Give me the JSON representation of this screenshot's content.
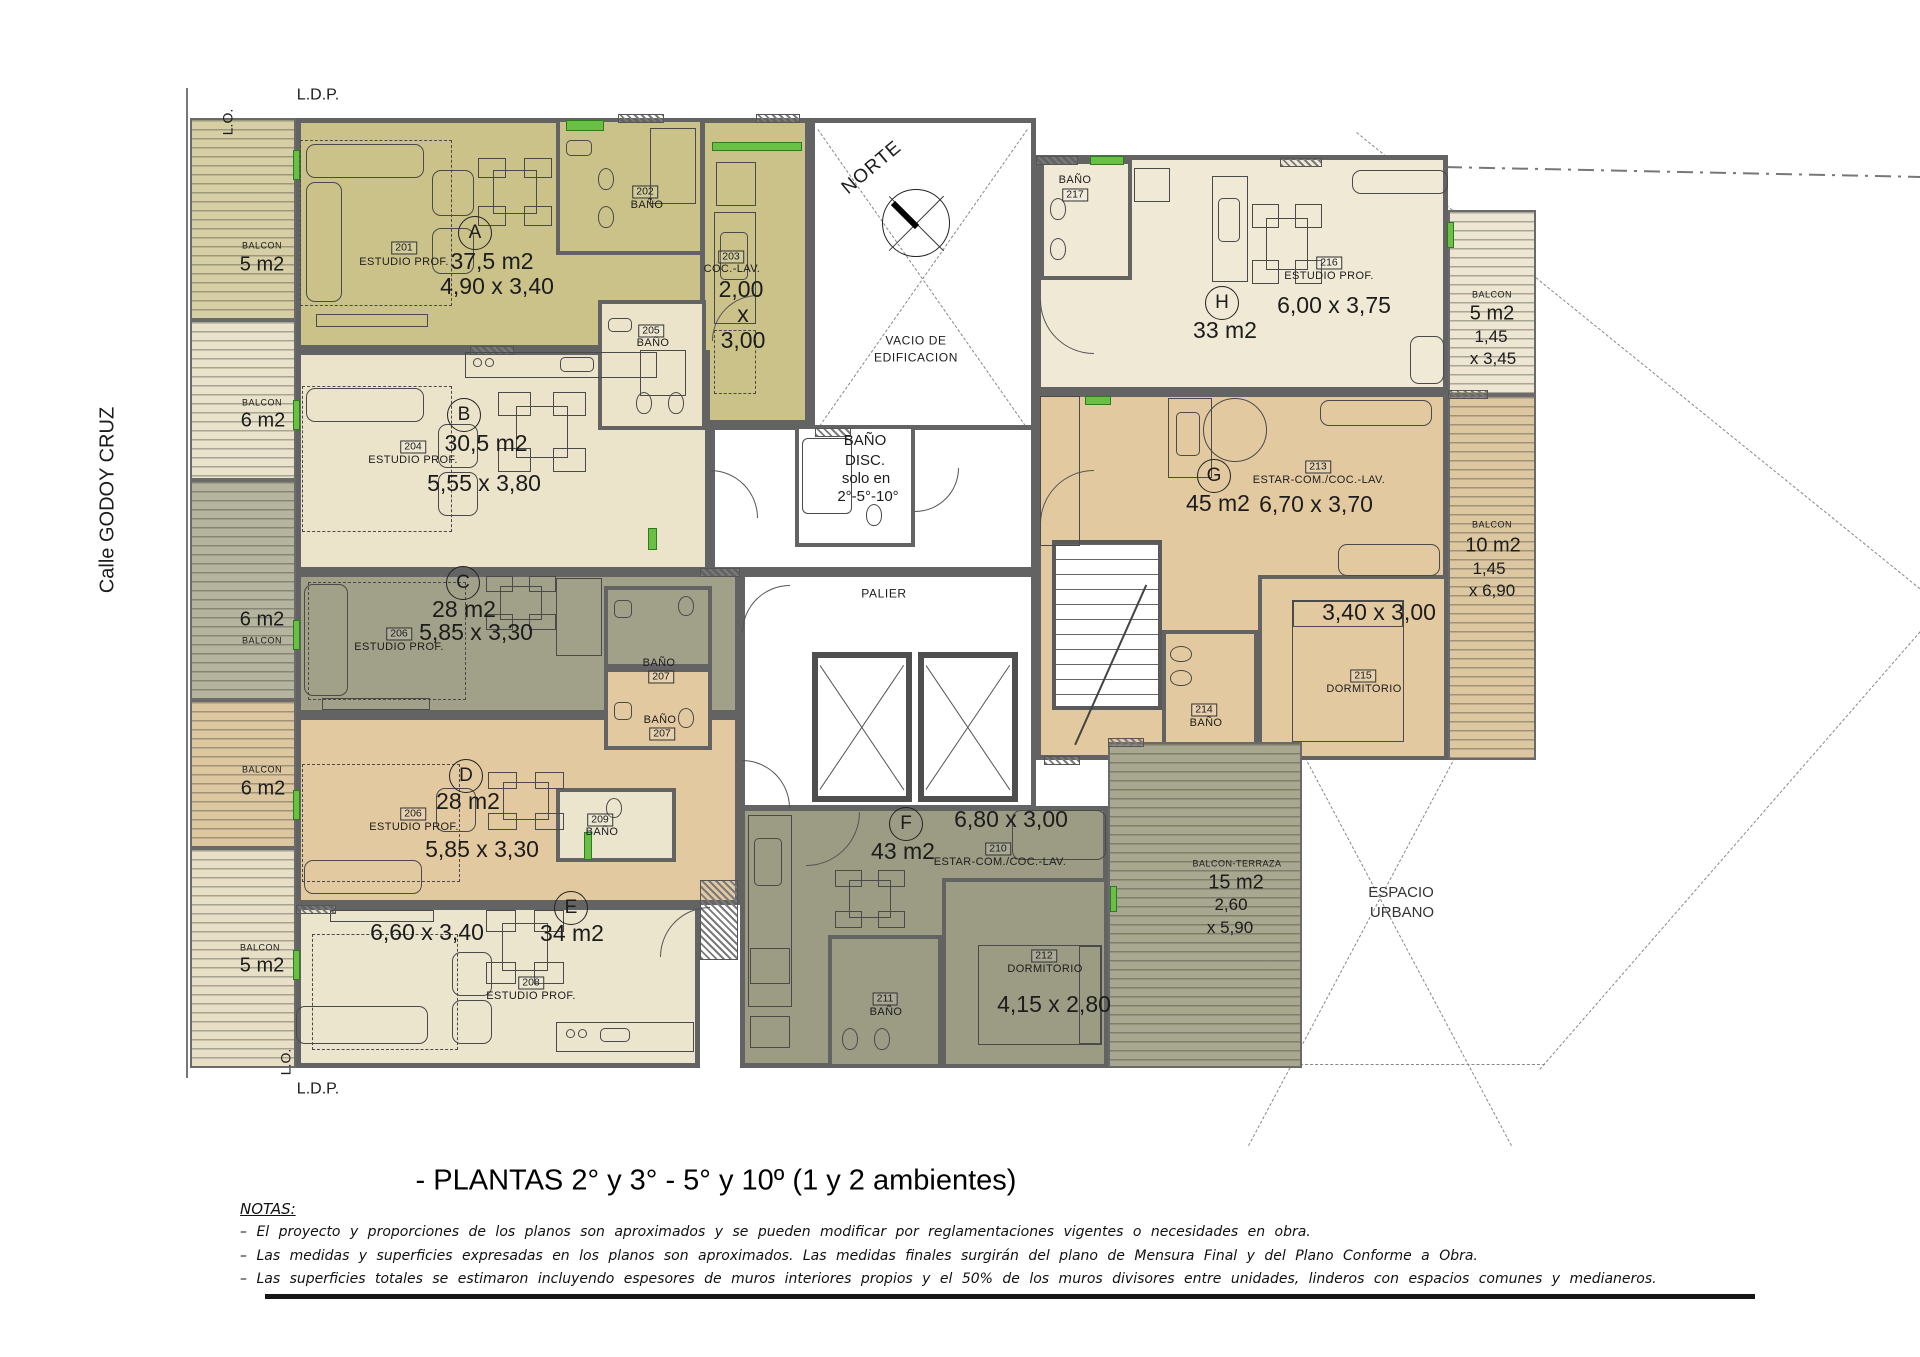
{
  "street": "Calle  GODOY CRUZ",
  "bounds": {
    "ldp_top": "L.D.P.",
    "lo_top": "L.O.",
    "lo_bottom": "L.O.",
    "ldp_bottom": "L.D.P."
  },
  "compass_label": "NORTE",
  "core": {
    "vacio1": "VACIO DE",
    "vacio2": "EDIFICACION",
    "disc1": "BAÑO",
    "disc2": "DISC.",
    "disc3": "solo en",
    "disc4": "2°-5°-10°",
    "palier": "PALIER"
  },
  "espacio": {
    "l1": "ESPACIO",
    "l2": "URBANO"
  },
  "units": {
    "A": {
      "letter": "A",
      "area": "37,5 m2",
      "dims": "4,90 x 3,40",
      "id": "201",
      "name": "ESTUDIO PROF."
    },
    "B": {
      "letter": "B",
      "area": "30,5 m2",
      "dims": "5,55 x 3,80",
      "id": "204",
      "name": "ESTUDIO PROF."
    },
    "C": {
      "letter": "C",
      "area": "28 m2",
      "dims": "5,85 x 3,30",
      "id": "206",
      "name": "ESTUDIO PROF."
    },
    "D": {
      "letter": "D",
      "area": "28 m2",
      "dims": "5,85 x 3,30",
      "id": "206",
      "name": "ESTUDIO PROF."
    },
    "E": {
      "letter": "E",
      "area": "34 m2",
      "dims": "6,60 x 3,40",
      "id": "208",
      "name": "ESTUDIO PROF."
    },
    "F": {
      "letter": "F",
      "area": "43 m2",
      "estar_id": "210",
      "estar_name": "ESTAR-COM./COC.-LAV.",
      "estar_dims": "6,80 x 3,00",
      "dorm_id": "212",
      "dorm_name": "DORMITORIO",
      "dorm_dims": "4,15 x 2,80",
      "bath_id": "211",
      "bath_name": "BAÑO"
    },
    "G": {
      "letter": "G",
      "area": "45 m2",
      "estar_id": "213",
      "estar_name": "ESTAR-COM./COC.-LAV.",
      "estar_dims": "6,70 x 3,70",
      "dorm_id": "215",
      "dorm_name": "DORMITORIO",
      "dorm_dims": "3,40 x 3,00",
      "bath_id": "214",
      "bath_name": "BAÑO"
    },
    "H": {
      "letter": "H",
      "area": "33 m2",
      "id": "216",
      "name": "ESTUDIO PROF.",
      "dims": "6,00 x 3,75",
      "bath_id": "217",
      "bath_name": "BAÑO"
    }
  },
  "rooms": {
    "b202": {
      "id": "202",
      "name": "BAÑO"
    },
    "c203": {
      "id": "203",
      "name": "COC.-LAV.",
      "d1": "2,00",
      "d2": "x",
      "d3": "3,00"
    },
    "b205": {
      "id": "205",
      "name": "BAÑO"
    },
    "b207c": {
      "id": "207",
      "name": "BAÑO"
    },
    "b207d": {
      "id": "207",
      "name": "BAÑO"
    },
    "b209": {
      "id": "209",
      "name": "BAÑO"
    }
  },
  "balconies": {
    "la": {
      "name": "BALCON",
      "area": "5 m2"
    },
    "lb": {
      "name": "BALCON",
      "area": "6 m2"
    },
    "lc": {
      "area": "6 m2",
      "name": "BALCON"
    },
    "ld": {
      "name": "BALCON",
      "area": "6 m2"
    },
    "le": {
      "name": "BALCON",
      "area": "5 m2"
    },
    "rh": {
      "name": "BALCON",
      "area": "5 m2",
      "d1": "1,45",
      "d2": "x 3,45"
    },
    "rg": {
      "name": "BALCON",
      "area": "10 m2",
      "d1": "1,45",
      "d2": "x 6,90"
    },
    "tz": {
      "name": "BALCON-TERRAZA",
      "area": "15 m2",
      "d1": "2,60",
      "d2": "x 5,90"
    }
  },
  "footer": {
    "title": "- PLANTAS 2° y 3° - 5° y 10º (1 y 2 ambientes)",
    "notes_heading": "NOTAS:",
    "notes": [
      "–  El proyecto y proporciones de los planos son aproximados y se pueden modificar por reglamentaciones vigentes o necesidades en obra.",
      "–  Las medidas y superficies expresadas en los planos son aproximados. Las medidas finales surgirán del plano de Mensura Final y del Plano Conforme a Obra.",
      "–  Las superficies totales se estimaron incluyendo espesores de muros interiores propios y el 50% de los muros divisores entre unidades, linderos con espacios comunes y medianeros."
    ]
  },
  "colors": {
    "khaki": "#cbc28a",
    "cream": "#ebe4ca",
    "sage": "#a1a089",
    "tan": "#e3c9a0",
    "cream2": "#efe9d6",
    "sage_dark": "#9c9b84",
    "wall": "#636363",
    "accent_green": "#6abf45"
  }
}
